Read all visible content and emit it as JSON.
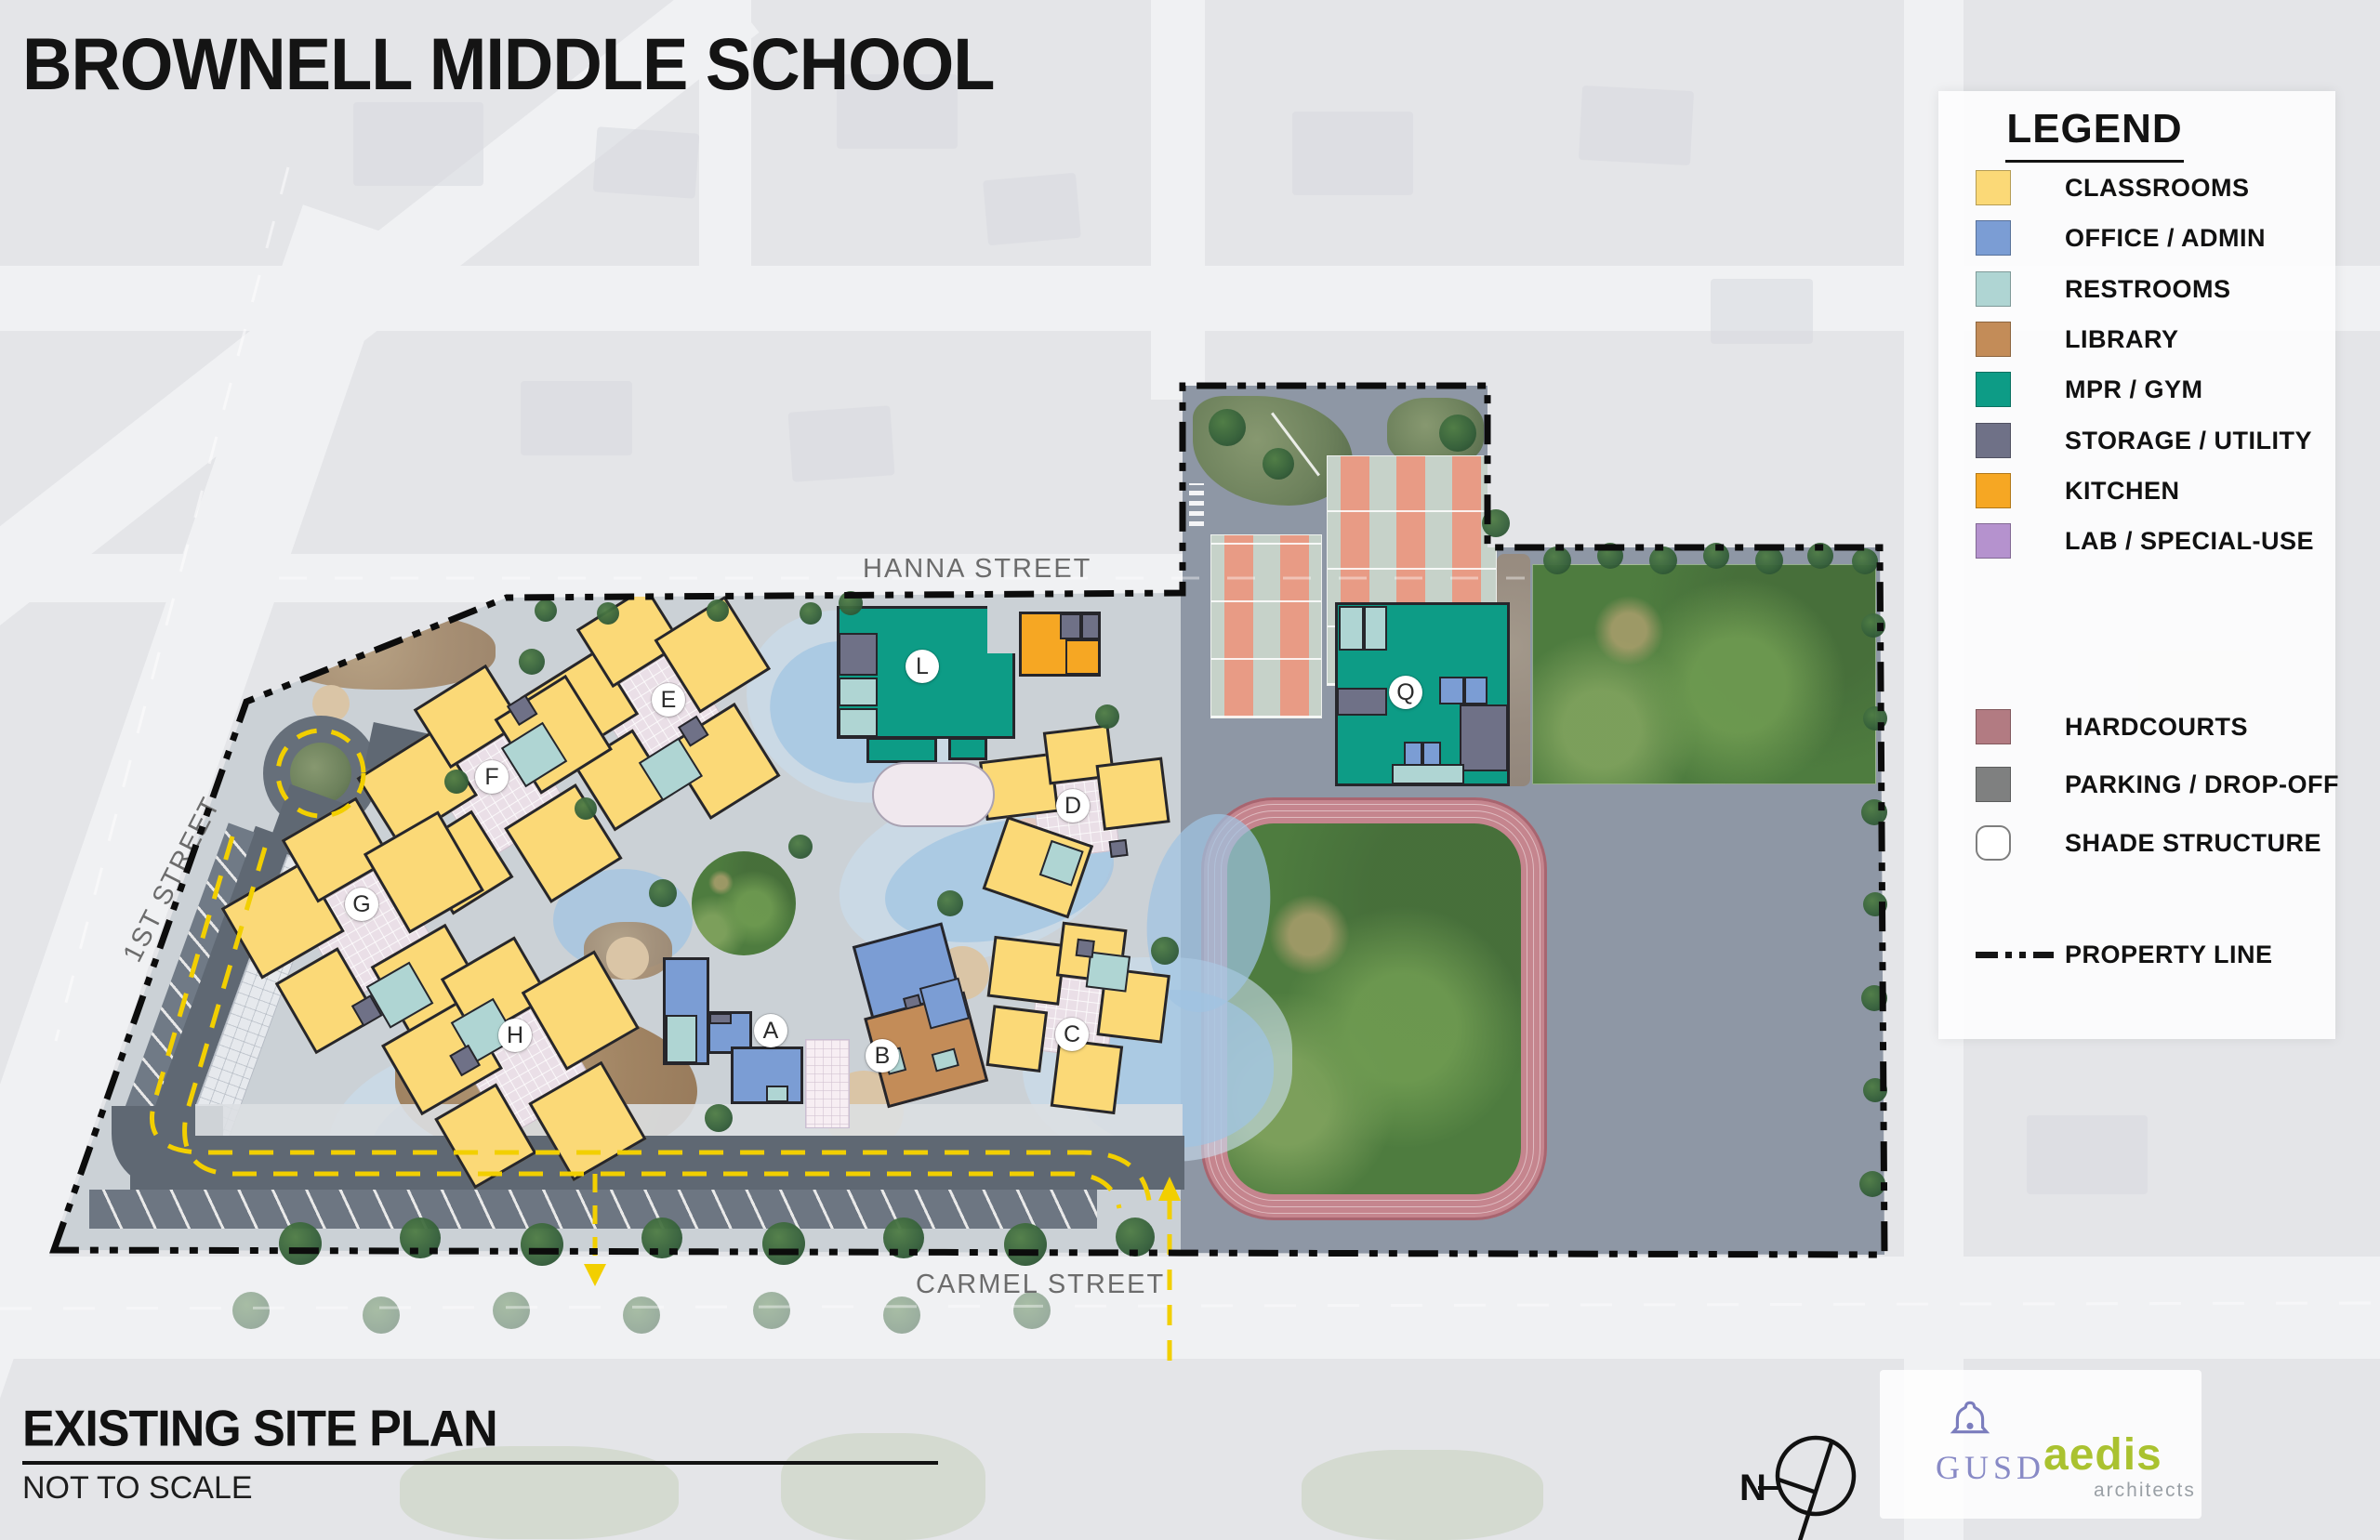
{
  "title": "BROWNELL MIDDLE SCHOOL",
  "plan": {
    "name": "EXISTING SITE PLAN",
    "scale_note": "NOT TO SCALE"
  },
  "legend": {
    "header": "LEGEND",
    "items": [
      {
        "label": "CLASSROOMS",
        "color": "#FBD977",
        "css_var": "--c-classrooms",
        "kind": "swatch"
      },
      {
        "label": "OFFICE / ADMIN",
        "color": "#7B9DD4",
        "css_var": "--c-office",
        "kind": "swatch"
      },
      {
        "label": "RESTROOMS",
        "color": "#AFD5D3",
        "css_var": "--c-restrooms",
        "kind": "swatch"
      },
      {
        "label": "LIBRARY",
        "color": "#C38C58",
        "css_var": "--c-library",
        "kind": "swatch"
      },
      {
        "label": "MPR / GYM",
        "color": "#0D9C86",
        "css_var": "--c-mpr",
        "kind": "swatch"
      },
      {
        "label": "STORAGE / UTILITY",
        "color": "#6F7187",
        "css_var": "--c-storage",
        "kind": "swatch"
      },
      {
        "label": "KITCHEN",
        "color": "#F6A723",
        "css_var": "--c-kitchen",
        "kind": "swatch"
      },
      {
        "label": "LAB / SPECIAL-USE",
        "color": "#B592CE",
        "css_var": "--c-lab",
        "kind": "swatch"
      },
      {
        "label": "HARDCOURTS",
        "color": "#B27B82",
        "css_var": "--c-hardcourts",
        "kind": "swatch"
      },
      {
        "label": "PARKING / DROP-OFF",
        "color": "#7F8080",
        "css_var": "--c-parking",
        "kind": "swatch"
      },
      {
        "label": "SHADE STRUCTURE",
        "color": "#FFFFFF",
        "css_var": "--c-shade",
        "kind": "circle"
      },
      {
        "label": "PROPERTY LINE",
        "color": "#111111",
        "css_var": "--c-propline",
        "kind": "line"
      }
    ]
  },
  "streets": {
    "hanna": "HANNA STREET",
    "carmel": "CARMEL STREET",
    "first": "1ST STREET"
  },
  "markers": [
    {
      "letter": "A"
    },
    {
      "letter": "B"
    },
    {
      "letter": "C"
    },
    {
      "letter": "D"
    },
    {
      "letter": "E"
    },
    {
      "letter": "F"
    },
    {
      "letter": "G"
    },
    {
      "letter": "H"
    },
    {
      "letter": "L"
    },
    {
      "letter": "Q"
    }
  ],
  "north_label": "N",
  "logos": {
    "gusd": "GUSD",
    "aedis": "aedis",
    "aedis_sub": "architects"
  }
}
